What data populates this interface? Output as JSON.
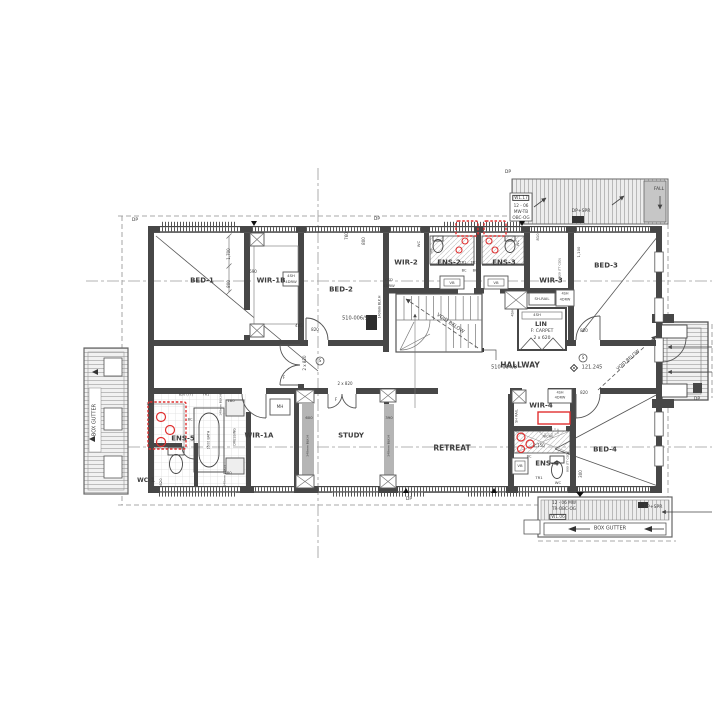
{
  "plan": {
    "drawing_type": "architectural floor plan - upper storey",
    "ink_color": "#3d3d3d",
    "highlight_color": "#e03030",
    "rooms": [
      "BED-1",
      "WIR-1B",
      "BED-2",
      "WIR-2",
      "ENS-2",
      "ENS-3",
      "WIR-3",
      "BED-3",
      "LIN",
      "HALLWAY",
      "ENS-5",
      "WC-1",
      "WIR-1A",
      "STUDY",
      "RETREAT",
      "WIR-4",
      "ENS-4",
      "BED-4"
    ],
    "labels": [
      {
        "n": "room-bed-1",
        "t": "BED-1",
        "x": 202,
        "y": 281,
        "s": 7,
        "b": 1
      },
      {
        "n": "room-wir-1b",
        "t": "WIR-1B",
        "x": 271,
        "y": 281,
        "s": 7,
        "b": 1
      },
      {
        "n": "room-bed-2",
        "t": "BED-2",
        "x": 341,
        "y": 290,
        "s": 7,
        "b": 1
      },
      {
        "n": "room-wir-2",
        "t": "WIR-2",
        "x": 406,
        "y": 263,
        "s": 7,
        "b": 1
      },
      {
        "n": "room-ens-2",
        "t": "ENS-2",
        "x": 449,
        "y": 263,
        "s": 7,
        "b": 1
      },
      {
        "n": "room-ens-3",
        "t": "ENS-3",
        "x": 504,
        "y": 263,
        "s": 7,
        "b": 1
      },
      {
        "n": "room-wir-3",
        "t": "WIR-3",
        "x": 551,
        "y": 281,
        "s": 7,
        "b": 1
      },
      {
        "n": "room-bed-3",
        "t": "BED-3",
        "x": 606,
        "y": 266,
        "s": 7,
        "b": 1
      },
      {
        "n": "room-lin",
        "t": "LIN",
        "x": 541,
        "y": 324,
        "s": 6.5,
        "b": 1
      },
      {
        "n": "lin-finish",
        "t": "F: CARPET",
        "x": 542,
        "y": 332,
        "s": 4.5
      },
      {
        "n": "lin-doors",
        "t": "2 x 620",
        "x": 542,
        "y": 339,
        "s": 4.5
      },
      {
        "n": "room-hallway",
        "t": "HALLWAY",
        "x": 520,
        "y": 365,
        "s": 7.5,
        "b": 1
      },
      {
        "n": "room-wir-1a",
        "t": "WIR-1A",
        "x": 259,
        "y": 436,
        "s": 7,
        "b": 1
      },
      {
        "n": "room-ens-5",
        "t": "ENS-5",
        "x": 183,
        "y": 439,
        "s": 7,
        "b": 1
      },
      {
        "n": "room-wc-1",
        "t": "WC-1",
        "x": 146,
        "y": 481,
        "s": 6,
        "b": 1
      },
      {
        "n": "room-study",
        "t": "STUDY",
        "x": 351,
        "y": 436,
        "s": 7,
        "b": 1
      },
      {
        "n": "room-retreat",
        "t": "RETREAT",
        "x": 452,
        "y": 448,
        "s": 7.5,
        "b": 1
      },
      {
        "n": "room-wir-4",
        "t": "WIR-4",
        "x": 541,
        "y": 406,
        "s": 7,
        "b": 1
      },
      {
        "n": "room-ens-4",
        "t": "ENS-4",
        "x": 547,
        "y": 464,
        "s": 7,
        "b": 1
      },
      {
        "n": "room-bed-4",
        "t": "BED-4",
        "x": 605,
        "y": 450,
        "s": 7,
        "b": 1
      },
      {
        "n": "ref-510-006-9",
        "t": "510-006/9",
        "x": 355,
        "y": 319,
        "s": 5
      },
      {
        "n": "ref-510-004-8",
        "t": "510-004/8",
        "x": 504,
        "y": 368,
        "s": 5
      },
      {
        "n": "level-121-245",
        "t": "121.245",
        "x": 592,
        "y": 368,
        "s": 5
      },
      {
        "n": "void-below-stair",
        "t": "VOID BELOW",
        "x": 450,
        "y": 324,
        "s": 5,
        "r": 34
      },
      {
        "n": "void-below-balcony",
        "t": "VOID BELOW",
        "x": 629,
        "y": 361,
        "s": 4.5,
        "r": -41
      },
      {
        "n": "box-gutter-left",
        "t": "BOX GUTTER",
        "x": 95,
        "y": 420,
        "s": 5,
        "r": -90
      },
      {
        "n": "box-gutter-bottom",
        "t": "BOX GUTTER",
        "x": 610,
        "y": 529,
        "s": 5
      },
      {
        "n": "dp-1",
        "t": "DP",
        "x": 135,
        "y": 221,
        "s": 4.5
      },
      {
        "n": "dp-2",
        "t": "DP",
        "x": 377,
        "y": 220,
        "s": 4.5
      },
      {
        "n": "dp-3",
        "t": "DP",
        "x": 508,
        "y": 173,
        "s": 4.5
      },
      {
        "n": "dp-4",
        "t": "DP",
        "x": 409,
        "y": 500,
        "s": 4.5
      },
      {
        "n": "dp-5",
        "t": "DP",
        "x": 697,
        "y": 400,
        "s": 4.5
      },
      {
        "n": "dp-spr-top",
        "t": "DP+SPR",
        "x": 581,
        "y": 212,
        "s": 4.5
      },
      {
        "n": "dp-spr-bottom",
        "t": "DP+SPR",
        "x": 653,
        "y": 508,
        "s": 4.5
      },
      {
        "n": "fall",
        "t": "FALL",
        "x": 659,
        "y": 190,
        "s": 4.5
      },
      {
        "n": "win-w117",
        "t": "W1.17",
        "x": 521,
        "y": 198,
        "s": 4.2,
        "box": 1
      },
      {
        "n": "win-w117-size",
        "t": "12 - 06",
        "x": 521,
        "y": 206,
        "s": 4.2
      },
      {
        "n": "win-w117-spec1",
        "t": "MW-TB",
        "x": 521,
        "y": 212,
        "s": 4.2
      },
      {
        "n": "win-w117-spec2",
        "t": "OBC-OG",
        "x": 521,
        "y": 218,
        "s": 4.2
      },
      {
        "n": "win-w106-size",
        "t": "12 - 06 MW",
        "x": 564,
        "y": 503,
        "s": 4.2
      },
      {
        "n": "win-w106-spec",
        "t": "TR-OBC-OG",
        "x": 564,
        "y": 509,
        "s": 4.2
      },
      {
        "n": "win-w106",
        "t": "W1.06",
        "x": 558,
        "y": 517,
        "s": 4.2,
        "box": 1
      },
      {
        "n": "smoke-s-1",
        "t": "S",
        "x": 320,
        "y": 361,
        "s": 4
      },
      {
        "n": "smoke-s-2",
        "t": "S",
        "x": 583,
        "y": 358,
        "s": 4
      },
      {
        "n": "wir1b-shelf-1",
        "t": "4SH",
        "x": 291,
        "y": 276,
        "s": 3.8
      },
      {
        "n": "wir1b-shelf-2",
        "t": "4DRW",
        "x": 291,
        "y": 282,
        "s": 3.8
      },
      {
        "n": "dim-690",
        "t": "690",
        "x": 253,
        "y": 272,
        "s": 4
      },
      {
        "n": "dim-1700",
        "t": "1,700",
        "x": 229,
        "y": 254,
        "s": 4,
        "r": -90
      },
      {
        "n": "dim-800a",
        "t": "800",
        "x": 229,
        "y": 284,
        "s": 4,
        "r": -90
      },
      {
        "n": "dim-760",
        "t": "760",
        "x": 347,
        "y": 236,
        "s": 4,
        "r": -90
      },
      {
        "n": "dim-800b",
        "t": "800",
        "x": 364,
        "y": 241,
        "s": 4,
        "r": -90
      },
      {
        "n": "wir2-csd",
        "t": "CSD",
        "x": 389,
        "y": 280,
        "s": 3.8
      },
      {
        "n": "wir2-4drw",
        "t": "4DRW",
        "x": 389,
        "y": 286,
        "s": 3.8
      },
      {
        "n": "blkh-140-a",
        "t": "140mm BLK.H",
        "x": 380,
        "y": 307,
        "s": 3.2,
        "r": -90
      },
      {
        "n": "dim-485",
        "t": "485",
        "x": 299,
        "y": 326,
        "s": 4
      },
      {
        "n": "door-820-bed2",
        "t": "820",
        "x": 315,
        "y": 330,
        "s": 4
      },
      {
        "n": "door-2x820-bed1",
        "t": "2 x 820",
        "x": 305,
        "y": 363,
        "s": 4,
        "r": -90
      },
      {
        "n": "door-2x820-study",
        "t": "2 x 820",
        "x": 345,
        "y": 384,
        "s": 4
      },
      {
        "n": "door-820-bed3",
        "t": "820",
        "x": 584,
        "y": 331,
        "s": 4
      },
      {
        "n": "door-820-bed4",
        "t": "820",
        "x": 584,
        "y": 393,
        "s": 4
      },
      {
        "n": "wir3-shrail",
        "t": "SH-RAIL",
        "x": 542,
        "y": 299,
        "s": 3.8
      },
      {
        "n": "wir3-4sh",
        "t": "4SH",
        "x": 565,
        "y": 294,
        "s": 3.5
      },
      {
        "n": "wir3-4drw",
        "t": "4DRW",
        "x": 565,
        "y": 300,
        "s": 3.5
      },
      {
        "n": "lin-4sh",
        "t": "4SH",
        "x": 537,
        "y": 315,
        "s": 3.8
      },
      {
        "n": "lin-4sh-side",
        "t": "4SH",
        "x": 513,
        "y": 313,
        "s": 3.5,
        "r": -90
      },
      {
        "n": "wir4-shrail",
        "t": "SH RAIL",
        "x": 517,
        "y": 416,
        "s": 3.5,
        "r": -90
      },
      {
        "n": "wir4-4sh",
        "t": "4SH",
        "x": 560,
        "y": 393,
        "s": 3.5
      },
      {
        "n": "wir4-4drw",
        "t": "4DRW",
        "x": 560,
        "y": 398,
        "s": 3.5
      },
      {
        "n": "dim-2150",
        "t": "2,150",
        "x": 539,
        "y": 446,
        "s": 4
      },
      {
        "n": "ens4-niche",
        "t": "NICHE",
        "x": 548,
        "y": 437,
        "s": 3.5
      },
      {
        "n": "ens4-bc",
        "t": "BC",
        "x": 529,
        "y": 457,
        "s": 3.5
      },
      {
        "n": "ens4-vb",
        "t": "VB",
        "x": 520,
        "y": 466,
        "s": 3.8
      },
      {
        "n": "ens4-tr1",
        "t": "TR1",
        "x": 539,
        "y": 478,
        "s": 3.8
      },
      {
        "n": "ens4-wc",
        "t": "WC",
        "x": 558,
        "y": 483,
        "s": 3.8
      },
      {
        "n": "dim-300",
        "t": "300",
        "x": 581,
        "y": 474,
        "s": 4,
        "r": -90
      },
      {
        "n": "dim-800-ttcsd",
        "t": "800 (TT CSD)",
        "x": 568,
        "y": 462,
        "s": 3,
        "r": -90
      },
      {
        "n": "ens2-vb",
        "t": "VB",
        "x": 452,
        "y": 283,
        "s": 3.8
      },
      {
        "n": "ens3-vb",
        "t": "VB",
        "x": 496,
        "y": 283,
        "s": 3.8
      },
      {
        "n": "ens2-wc",
        "t": "WC",
        "x": 419,
        "y": 244,
        "s": 3.8,
        "r": -90
      },
      {
        "n": "ens3-wc",
        "t": "WC",
        "x": 518,
        "y": 243,
        "s": 3.8,
        "r": -90
      },
      {
        "n": "ens2-hb",
        "t": "HB",
        "x": 432,
        "y": 251,
        "s": 3.5,
        "r": -90
      },
      {
        "n": "ens2-tr1",
        "t": "TR1",
        "x": 463,
        "y": 263,
        "s": 3.5
      },
      {
        "n": "ens3-tr1",
        "t": "TR1",
        "x": 474,
        "y": 263,
        "s": 3.5
      },
      {
        "n": "ens2-bc",
        "t": "BC",
        "x": 464,
        "y": 271,
        "s": 3.5
      },
      {
        "n": "ens3-bc",
        "t": "BC",
        "x": 475,
        "y": 271,
        "s": 3.5
      },
      {
        "n": "dim-180-a",
        "t": "180",
        "x": 150,
        "y": 404,
        "s": 3.8
      },
      {
        "n": "dim-180-b",
        "t": "180",
        "x": 231,
        "y": 401,
        "s": 3.8
      },
      {
        "n": "dim-180-c",
        "t": "180",
        "x": 228,
        "y": 473,
        "s": 3.8
      },
      {
        "n": "door-620-wc1",
        "t": "620",
        "x": 161,
        "y": 482,
        "s": 3.8,
        "r": -90
      },
      {
        "n": "ens5-820tt",
        "t": "820 (TT)",
        "x": 186,
        "y": 395,
        "s": 3.4
      },
      {
        "n": "ens5-tr1",
        "t": "TR1",
        "x": 206,
        "y": 395,
        "s": 3.4
      },
      {
        "n": "blkh-140-b",
        "t": "140mm BLK.H",
        "x": 221,
        "y": 405,
        "s": 3,
        "r": -90
      },
      {
        "n": "blkh-140-c",
        "t": "140mm BLK.H",
        "x": 225,
        "y": 476,
        "s": 3,
        "r": -90
      },
      {
        "n": "ens5-bc",
        "t": "BC",
        "x": 190,
        "y": 420,
        "s": 3.5
      },
      {
        "n": "ens5-bath",
        "t": "1500 BATH",
        "x": 209,
        "y": 440,
        "s": 3.4,
        "r": -90
      },
      {
        "n": "wir1a-dressing",
        "t": "DRESSING",
        "x": 235,
        "y": 437,
        "s": 3.4,
        "r": -90
      },
      {
        "n": "mh-box",
        "t": "MH",
        "x": 280,
        "y": 407,
        "s": 4.2
      },
      {
        "n": "dim-600",
        "t": "600",
        "x": 309,
        "y": 418,
        "s": 3.8
      },
      {
        "n": "dim-390",
        "t": "390",
        "x": 389,
        "y": 418,
        "s": 3.8
      },
      {
        "n": "blkh-340-a",
        "t": "340mm BLK.H",
        "x": 308,
        "y": 446,
        "s": 3,
        "r": -90
      },
      {
        "n": "blkh-340-b",
        "t": "340mm BLK.H",
        "x": 389,
        "y": 446,
        "s": 3,
        "r": -90
      },
      {
        "n": "door-f-1",
        "t": "F",
        "x": 284,
        "y": 378,
        "s": 4
      },
      {
        "n": "door-f-2",
        "t": "F",
        "x": 336,
        "y": 400,
        "s": 4
      },
      {
        "n": "dim-810",
        "t": "810",
        "x": 538,
        "y": 237,
        "s": 3.8,
        "r": -90
      },
      {
        "n": "dim-1100",
        "t": "1,100",
        "x": 579,
        "y": 252,
        "s": 3.8,
        "r": -90
      },
      {
        "n": "dim-820-ttcsd",
        "t": "820 (TT CSD)",
        "x": 560,
        "y": 268,
        "s": 3,
        "r": -90
      }
    ]
  }
}
